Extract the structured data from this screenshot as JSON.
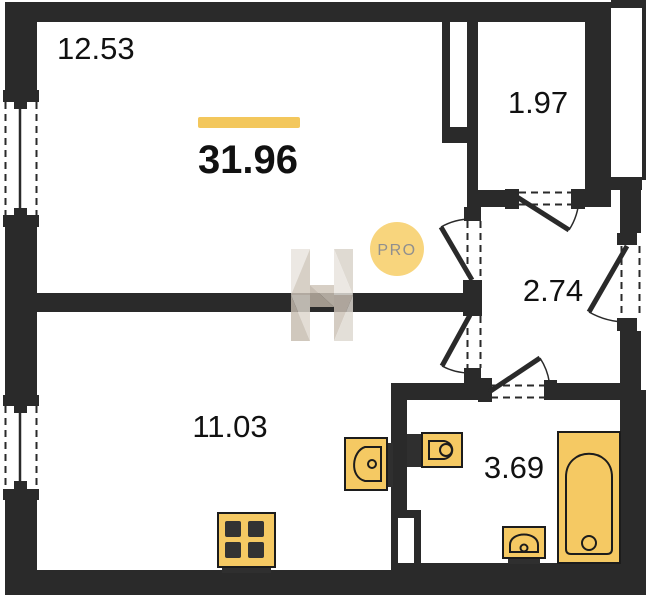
{
  "plan": {
    "total": {
      "value": "31.96"
    },
    "rooms": [
      {
        "id": "living-room",
        "area": "12.53"
      },
      {
        "id": "closet",
        "area": "1.97"
      },
      {
        "id": "hallway",
        "area": "2.74"
      },
      {
        "id": "kitchen-room",
        "area": "11.03"
      },
      {
        "id": "bathroom",
        "area": "3.69"
      }
    ],
    "badge": {
      "label": "PRO"
    },
    "icons": [
      "stove-icon",
      "kitchen-sink-icon",
      "toilet-icon",
      "washbasin-icon",
      "bathtub-icon",
      "logo-h-icon",
      "pro-badge-icon"
    ],
    "colors": {
      "wall": "#2a2a2a",
      "fixture_fill": "#f5c963",
      "fixture_stroke": "#1c1c1c",
      "accent_bar": "#f3c75c",
      "badge_bg": "#f8d57d",
      "badge_text": "#8f8f8f",
      "logo_beige_light": "#e8e4de",
      "logo_beige_mid": "#d3cabf",
      "logo_beige_dark": "#c6bcaf",
      "background": "#ffffff"
    }
  }
}
